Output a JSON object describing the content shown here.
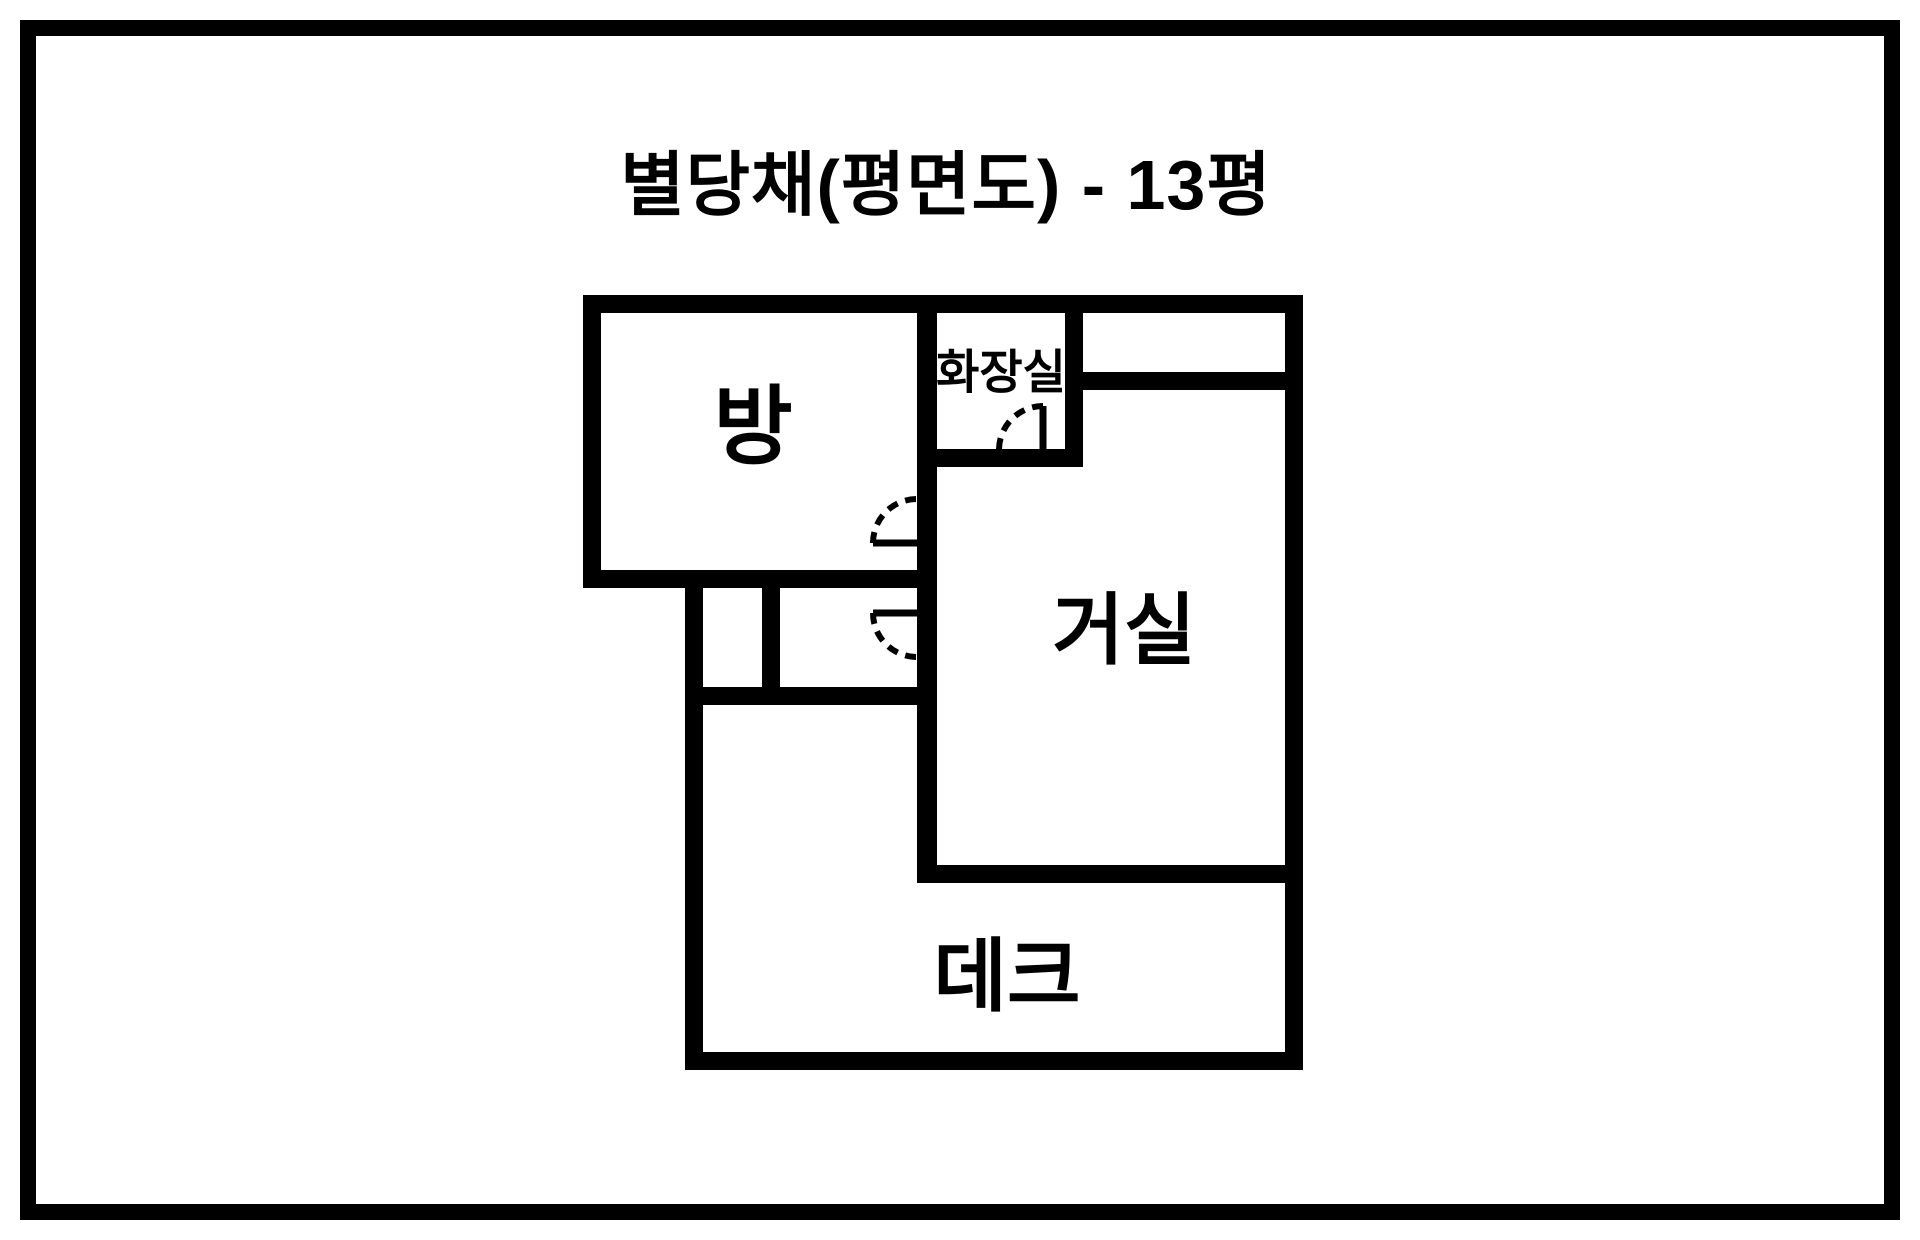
{
  "title": "별당채(평면도) - 13평",
  "plan": {
    "name": "별당채",
    "drawing_type": "평면도",
    "area": "13평",
    "rooms": [
      {
        "id": "room",
        "label": "방"
      },
      {
        "id": "bathroom",
        "label": "화장실"
      },
      {
        "id": "living_room",
        "label": "거실"
      },
      {
        "id": "deck",
        "label": "데크"
      }
    ],
    "door_count": 3
  },
  "colors": {
    "wall": "#000000",
    "background": "#ffffff",
    "text": "#000000"
  }
}
